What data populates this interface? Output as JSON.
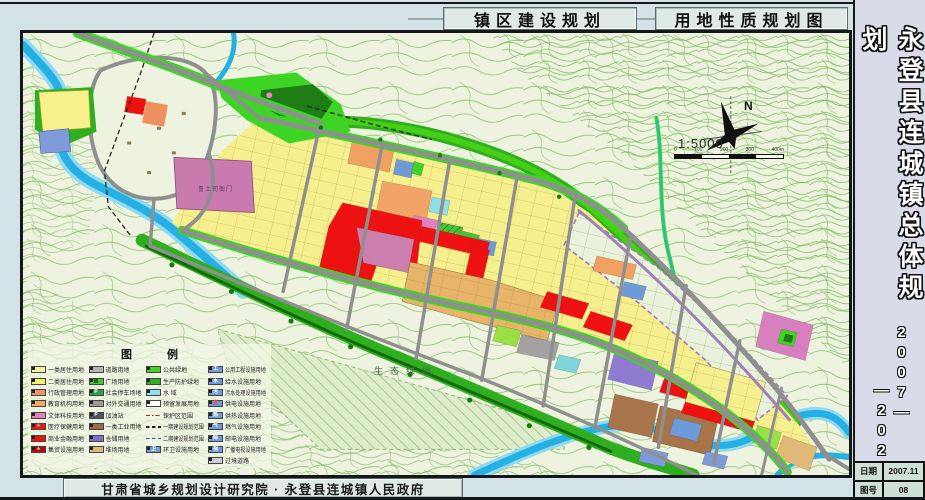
{
  "header": {
    "title_left": "镇区建设规划",
    "title_right": "用地性质规划图"
  },
  "sidebar": {
    "title": "永登县连城镇总体规划",
    "period_start": "2007—",
    "period_end": "—2020",
    "info": {
      "date_label": "日期",
      "date_value": "2007.11",
      "sheet_label": "图号",
      "sheet_value": "08"
    }
  },
  "footer": {
    "credit": "甘肃省城乡规划设计研究院 · 永登县连城镇人民政府"
  },
  "map": {
    "labels": {
      "eco_green": "生态绿地",
      "heritage": "鲁土司衙门",
      "north": "N",
      "scale_text": "1:5000",
      "scale_ticks": [
        "0",
        "100",
        "200",
        "300",
        "400m"
      ]
    },
    "legend": {
      "title": "图 例",
      "columns": [
        {
          "items": [
            {
              "label": "一类居住用地",
              "swatch": {
                "type": "fill",
                "color": "#fdf3a0"
              }
            },
            {
              "label": "二类居住用地",
              "swatch": {
                "type": "fill",
                "color": "#f9ee6a"
              }
            },
            {
              "label": "行政管理用地",
              "swatch": {
                "type": "fill",
                "color": "#f2926a"
              }
            },
            {
              "label": "教育机构用地",
              "swatch": {
                "type": "fill",
                "color": "#f2a96a"
              }
            },
            {
              "label": "文体科技用地",
              "swatch": {
                "type": "fill",
                "color": "#e37fc0"
              }
            },
            {
              "label": "医疗保健用地",
              "swatch": {
                "type": "fill",
                "color": "#f21717",
                "symbol": "+",
                "symbolColor": "#ffffff"
              }
            },
            {
              "label": "商业金融用地",
              "swatch": {
                "type": "fill",
                "color": "#ee1111"
              }
            },
            {
              "label": "集贸设施用地",
              "swatch": {
                "type": "fill",
                "color": "#c00808",
                "symbol": "●",
                "symbolColor": "#ffffff"
              }
            }
          ]
        },
        {
          "items": [
            {
              "label": "道路用地",
              "swatch": {
                "type": "fill",
                "color": "#b5b5b5"
              }
            },
            {
              "label": "广场用地",
              "swatch": {
                "type": "fill",
                "color": "#49c43a",
                "symbol": "▥",
                "symbolColor": "#0c4d08"
              }
            },
            {
              "label": "社会停车场地",
              "swatch": {
                "type": "fill",
                "color": "#2f9e4f",
                "symbol": "P",
                "symbolColor": "#ffffff"
              }
            },
            {
              "label": "对外交通用地",
              "swatch": {
                "type": "fill",
                "color": "#9a9a9a"
              }
            },
            {
              "label": "加油站",
              "swatch": {
                "type": "fill",
                "color": "#4a5568",
                "symbol": "P",
                "symbolColor": "#ffffff"
              }
            },
            {
              "label": "一类工业用地",
              "swatch": {
                "type": "fill",
                "color": "#9c6b42"
              }
            },
            {
              "label": "仓储用地",
              "swatch": {
                "type": "fill",
                "color": "#7b6fd0"
              }
            },
            {
              "label": "堆场用地",
              "swatch": {
                "type": "fill",
                "color": "#e0b878"
              }
            }
          ]
        },
        {
          "items": [
            {
              "label": "公共绿地",
              "swatch": {
                "type": "fill",
                "color": "#3ed426"
              }
            },
            {
              "label": "生产防护绿地",
              "swatch": {
                "type": "fill",
                "color": "#2fae1f"
              }
            },
            {
              "label": "水  域",
              "swatch": {
                "type": "fill",
                "color": "#8fe0f0"
              }
            },
            {
              "label": "预留发展用地",
              "swatch": {
                "type": "fill",
                "color": "#ffffff"
              }
            },
            {
              "label": "保护区范围",
              "swatch": {
                "type": "line",
                "style": "dashdot",
                "color": "#e01010"
              }
            },
            {
              "label": "一期建设规划范围",
              "swatch": {
                "type": "line",
                "style": "dashed",
                "color": "#222222"
              }
            },
            {
              "label": "二期建设规划范围",
              "swatch": {
                "type": "line",
                "style": "dashed",
                "color": "#2255cc"
              }
            },
            {
              "label": "环卫设施用地",
              "swatch": {
                "type": "fill",
                "color": "#6f9ad8",
                "symbol": "卫",
                "symbolColor": "#ffffff"
              }
            }
          ]
        },
        {
          "items": [
            {
              "label": "公用工程设施用地",
              "swatch": {
                "type": "fill",
                "color": "#6f9ad8",
                "symbol": "工",
                "symbolColor": "#ffffff"
              }
            },
            {
              "label": "给水设施用地",
              "swatch": {
                "type": "fill",
                "color": "#6f9ad8",
                "symbol": "水",
                "symbolColor": "#ffffff"
              }
            },
            {
              "label": "污水处理设施用地",
              "swatch": {
                "type": "fill",
                "color": "#6f9ad8",
                "symbol": "污",
                "symbolColor": "#ffffff"
              }
            },
            {
              "label": "供电设施用地",
              "swatch": {
                "type": "fill",
                "color": "#6f9ad8",
                "symbol": "变",
                "symbolColor": "#ff4040"
              }
            },
            {
              "label": "供热设施用地",
              "swatch": {
                "type": "fill",
                "color": "#6f9ad8",
                "symbol": "热",
                "symbolColor": "#ffffff"
              }
            },
            {
              "label": "燃气设施用地",
              "swatch": {
                "type": "fill",
                "color": "#6f9ad8",
                "symbol": "气",
                "symbolColor": "#ffffff"
              }
            },
            {
              "label": "邮电设施用地",
              "swatch": {
                "type": "fill",
                "color": "#6f9ad8",
                "symbol": "邮",
                "symbolColor": "#ffffff"
              }
            },
            {
              "label": "广播电视设施用地",
              "swatch": {
                "type": "fill",
                "color": "#6f9ad8",
                "symbol": "视",
                "symbolColor": "#ffffff"
              }
            },
            {
              "label": "过境道路",
              "swatch": {
                "type": "fill",
                "color": "#cfcfcf"
              }
            }
          ]
        }
      ]
    }
  },
  "colors": {
    "page_bg": "#d2e2e6",
    "sidebar_bg": "#dadbe9",
    "map_bg": "#edf3de",
    "contour": "#8cbf70",
    "water": "#25b0e4",
    "green_space": "#2fae1f",
    "residential_yellow": "#f6ef8e",
    "commercial_red": "#ee1111",
    "cultural_pink": "#cc7fae",
    "education_orange": "#f0a060",
    "industrial_brown": "#a9744a",
    "storage_purple": "#8f7cd2",
    "utility_blue": "#6f9ad8",
    "road_gray": "#8f8f8f"
  }
}
